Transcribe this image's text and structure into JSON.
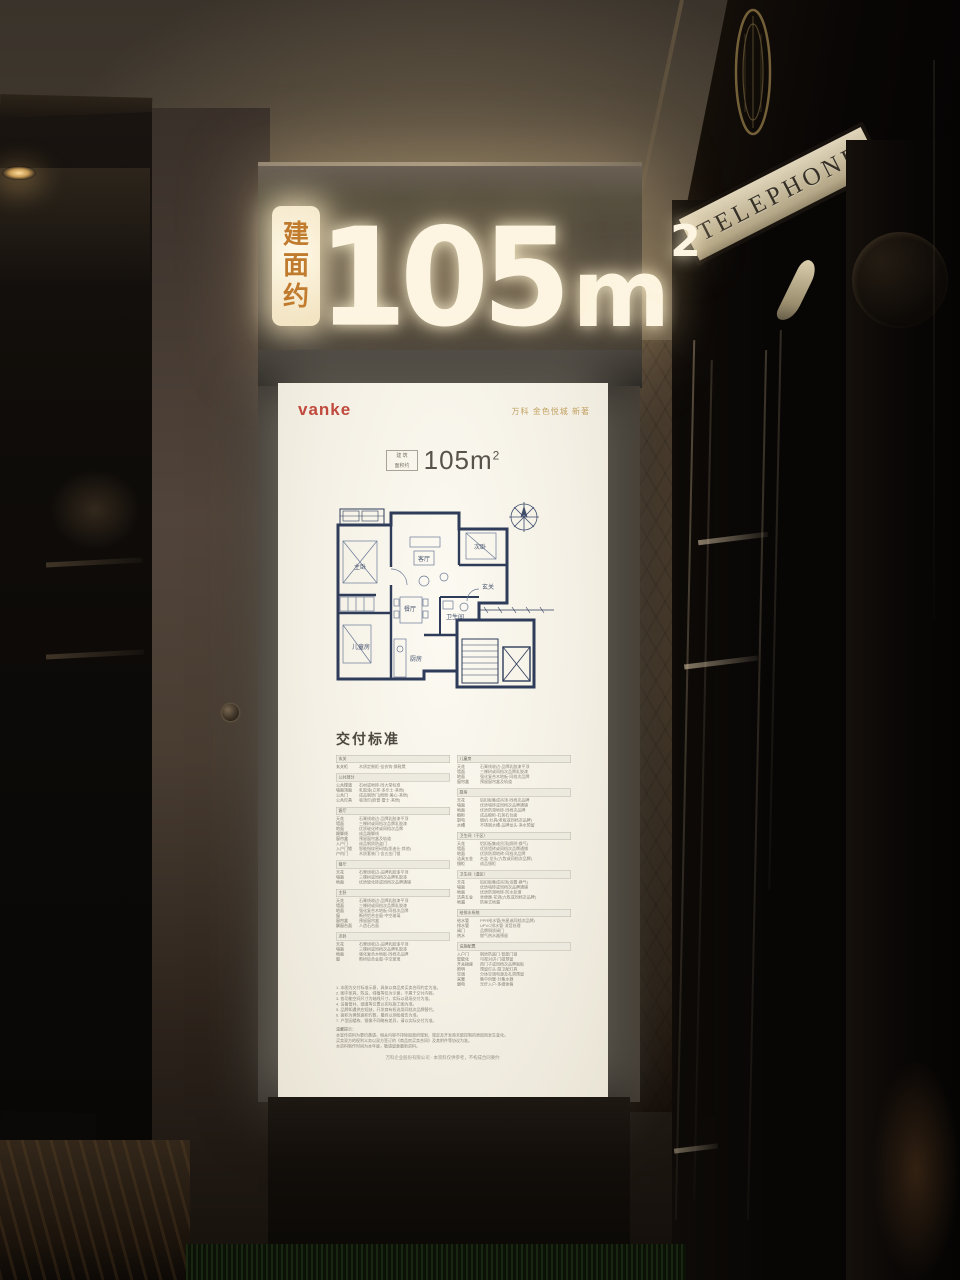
{
  "colors": {
    "sign_glow": "#fdf5e1",
    "label_orange": "#c07b2e",
    "brand_red": "#c04a3e",
    "gold_text": "#c2a263",
    "plan_blue": "#2e3c5a"
  },
  "top_sign": {
    "vertical_label": [
      "建",
      "面",
      "约"
    ],
    "number": "105",
    "unit": "m",
    "sup": "2"
  },
  "poster": {
    "brand": "vanke",
    "project": "万科 金色悦城 新著",
    "area_box_line1": "建 筑",
    "area_box_line2": "面积约",
    "area_value": "105m",
    "area_sup": "2",
    "floorplan": {
      "rooms": [
        "主卧",
        "客厅",
        "次卧",
        "餐厅",
        "儿童房",
        "厨房",
        "卫生间",
        "玄关"
      ]
    },
    "delivery_title": "交付标准",
    "spec": {
      "columns": [
        {
          "sections": [
            {
              "title": "玄关",
              "rows": [
                [
                  "玄关柜",
                  "木质定制柜·挂衣钩·换鞋凳"
                ]
              ]
            },
            {
              "title": "公共部分",
              "rows": [
                [
                  "公共楼道",
                  "石材或地砖·同大堂标准"
                ],
                [
                  "墙面顶面",
                  "乳胶漆(立邦·多乐士·其他)"
                ],
                [
                  "公共门",
                  "成品钢质门(盼盼·美心·其他)"
                ],
                [
                  "公共灯具",
                  "吸顶灯(欧普·雷士·其他)"
                ]
              ]
            },
            {
              "title": "客厅",
              "rows": [
                [
                  "天花",
                  "石膏线收边·品牌乳胶漆平顶"
                ],
                [
                  "墙面",
                  "三棵树或同档次品牌乳胶漆"
                ],
                [
                  "地面",
                  "优质玻化砖或同档次品牌"
                ],
                [
                  "踢脚线",
                  "成品踢脚线"
                ],
                [
                  "窗帘盒",
                  "预留窗帘盒及轨道"
                ],
                [
                  "入户门",
                  "成品钢质防盗门"
                ],
                [
                  "入户门锁",
                  "智能指纹密码锁(凯迪仕·其他)"
                ],
                [
                  "户内门",
                  "木质套装门·含五金门锁"
                ]
              ]
            },
            {
              "title": "餐厅",
              "rows": [
                [
                  "天花",
                  "石膏线收边·品牌乳胶漆平顶"
                ],
                [
                  "墙面",
                  "三棵树或同档次品牌乳胶漆"
                ],
                [
                  "地面",
                  "优质玻化砖或同档次品牌通铺"
                ]
              ]
            },
            {
              "title": "主卧",
              "rows": [
                [
                  "天花",
                  "石膏线收边·品牌乳胶漆平顶"
                ],
                [
                  "墙面",
                  "三棵树或同档次品牌乳胶漆"
                ],
                [
                  "地面",
                  "强化复合木地板·同档次品牌"
                ],
                [
                  "窗",
                  "断桥铝合金窗·中空玻璃"
                ],
                [
                  "窗帘盒",
                  "预留窗帘盒"
                ],
                [
                  "飘窗台面",
                  "人造石台面"
                ]
              ]
            },
            {
              "title": "次卧",
              "rows": [
                [
                  "天花",
                  "石膏线收边·品牌乳胶漆平顶"
                ],
                [
                  "墙面",
                  "三棵树或同档次品牌乳胶漆"
                ],
                [
                  "地面",
                  "强化复合木地板·同档次品牌"
                ],
                [
                  "窗",
                  "断桥铝合金窗·中空玻璃"
                ]
              ]
            }
          ]
        },
        {
          "sections": [
            {
              "title": "儿童房",
              "rows": [
                [
                  "天花",
                  "石膏线收边·品牌乳胶漆平顶"
                ],
                [
                  "墙面",
                  "三棵树或同档次品牌乳胶漆"
                ],
                [
                  "地面",
                  "强化复合木地板·同档次品牌"
                ],
                [
                  "窗帘盒",
                  "预留窗帘盒及轨道"
                ]
              ]
            },
            {
              "title": "厨房",
              "rows": [
                [
                  "天花",
                  "铝扣板集成吊顶·同档次品牌"
                ],
                [
                  "墙面",
                  "优质墙砖或同档次品牌通铺"
                ],
                [
                  "地面",
                  "优质防滑地砖·同档次品牌"
                ],
                [
                  "橱柜",
                  "成品橱柜·石英石台面"
                ],
                [
                  "厨电",
                  "烟机·灶具(老板或同档次品牌)"
                ],
                [
                  "水槽",
                  "不锈钢水槽·品牌龙头·净水预留"
                ]
              ]
            },
            {
              "title": "卫生间（干区）",
              "rows": [
                [
                  "天花",
                  "铝扣板集成吊顶(照明·换气)"
                ],
                [
                  "墙面",
                  "优质墙砖或同档次品牌通铺"
                ],
                [
                  "地面",
                  "优质防滑地砖·同档次品牌"
                ],
                [
                  "洁具五金",
                  "台盆·龙头(九牧或同档次品牌)"
                ],
                [
                  "镜柜",
                  "成品镜柜"
                ]
              ]
            },
            {
              "title": "卫生间（湿区）",
              "rows": [
                [
                  "天花",
                  "铝扣板集成吊顶(浴霸·换气)"
                ],
                [
                  "墙面",
                  "优质墙砖或同档次品牌通铺"
                ],
                [
                  "地面",
                  "优质防滑地砖·防水处理"
                ],
                [
                  "洁具五金",
                  "坐便器·花洒(九牧或同档次品牌)"
                ],
                [
                  "地漏",
                  "防臭式地漏"
                ]
              ]
            },
            {
              "title": "给排水系统",
              "rows": [
                [
                  "给水管",
                  "PPR给水管(伟星或同档次品牌)"
                ],
                [
                  "排水管",
                  "UPVC排水管·消音处理"
                ],
                [
                  "阀门",
                  "品牌铜质阀门"
                ],
                [
                  "热水",
                  "燃气热水器预留"
                ]
              ]
            },
            {
              "title": "设施配置",
              "rows": [
                [
                  "入户门",
                  "钢质防盗门·智能门锁"
                ],
                [
                  "智能化",
                  "可视对讲·门磁预留"
                ],
                [
                  "开关插座",
                  "西门子或同档次品牌面板"
                ],
                [
                  "照明",
                  "预留灯头·厨卫配灯具"
                ],
                [
                  "空调",
                  "分体空调电源及孔洞预留"
                ],
                [
                  "采暖",
                  "集中供暖·分集水器"
                ],
                [
                  "弱电",
                  "光纤入户·多媒体箱"
                ]
              ]
            }
          ]
        }
      ]
    },
    "notes": [
      "1. 本图为交付标准示意，具体以商品房买卖合同约定为准。",
      "2. 图中家具、陈设、绿植等仅为示意，不属于交付内容。",
      "3. 各功能空间尺寸为轴线尺寸，实际以现场交付为准。",
      "4. 设备管井、烟道等位置以实际施工图为准。",
      "5. 品牌如遇供应短缺，开发商有权选用同档次品牌替代。",
      "6. 面积为建筑面积约数，最终以测绘报告为准。",
      "7. 户型因楼栋、镜像不同略有差异，请以实际交付为准。"
    ],
    "tips_title": "温馨提示：",
    "tips": [
      "本宣传资料为要约邀请，相关内容不排除因政府规划、规定及开发商未能控制的原因而发生变化。",
      "买卖双方的权利义务以双方签订的《商品房买卖合同》及其附件等协议为准。",
      "本资料制作时间为本年度，敬请留意最新资料。"
    ],
    "footer": "万科企业股份有限公司 · 本资料仅供参考，不构成合同要约"
  },
  "booth": {
    "sign": "TELEPHONE"
  }
}
